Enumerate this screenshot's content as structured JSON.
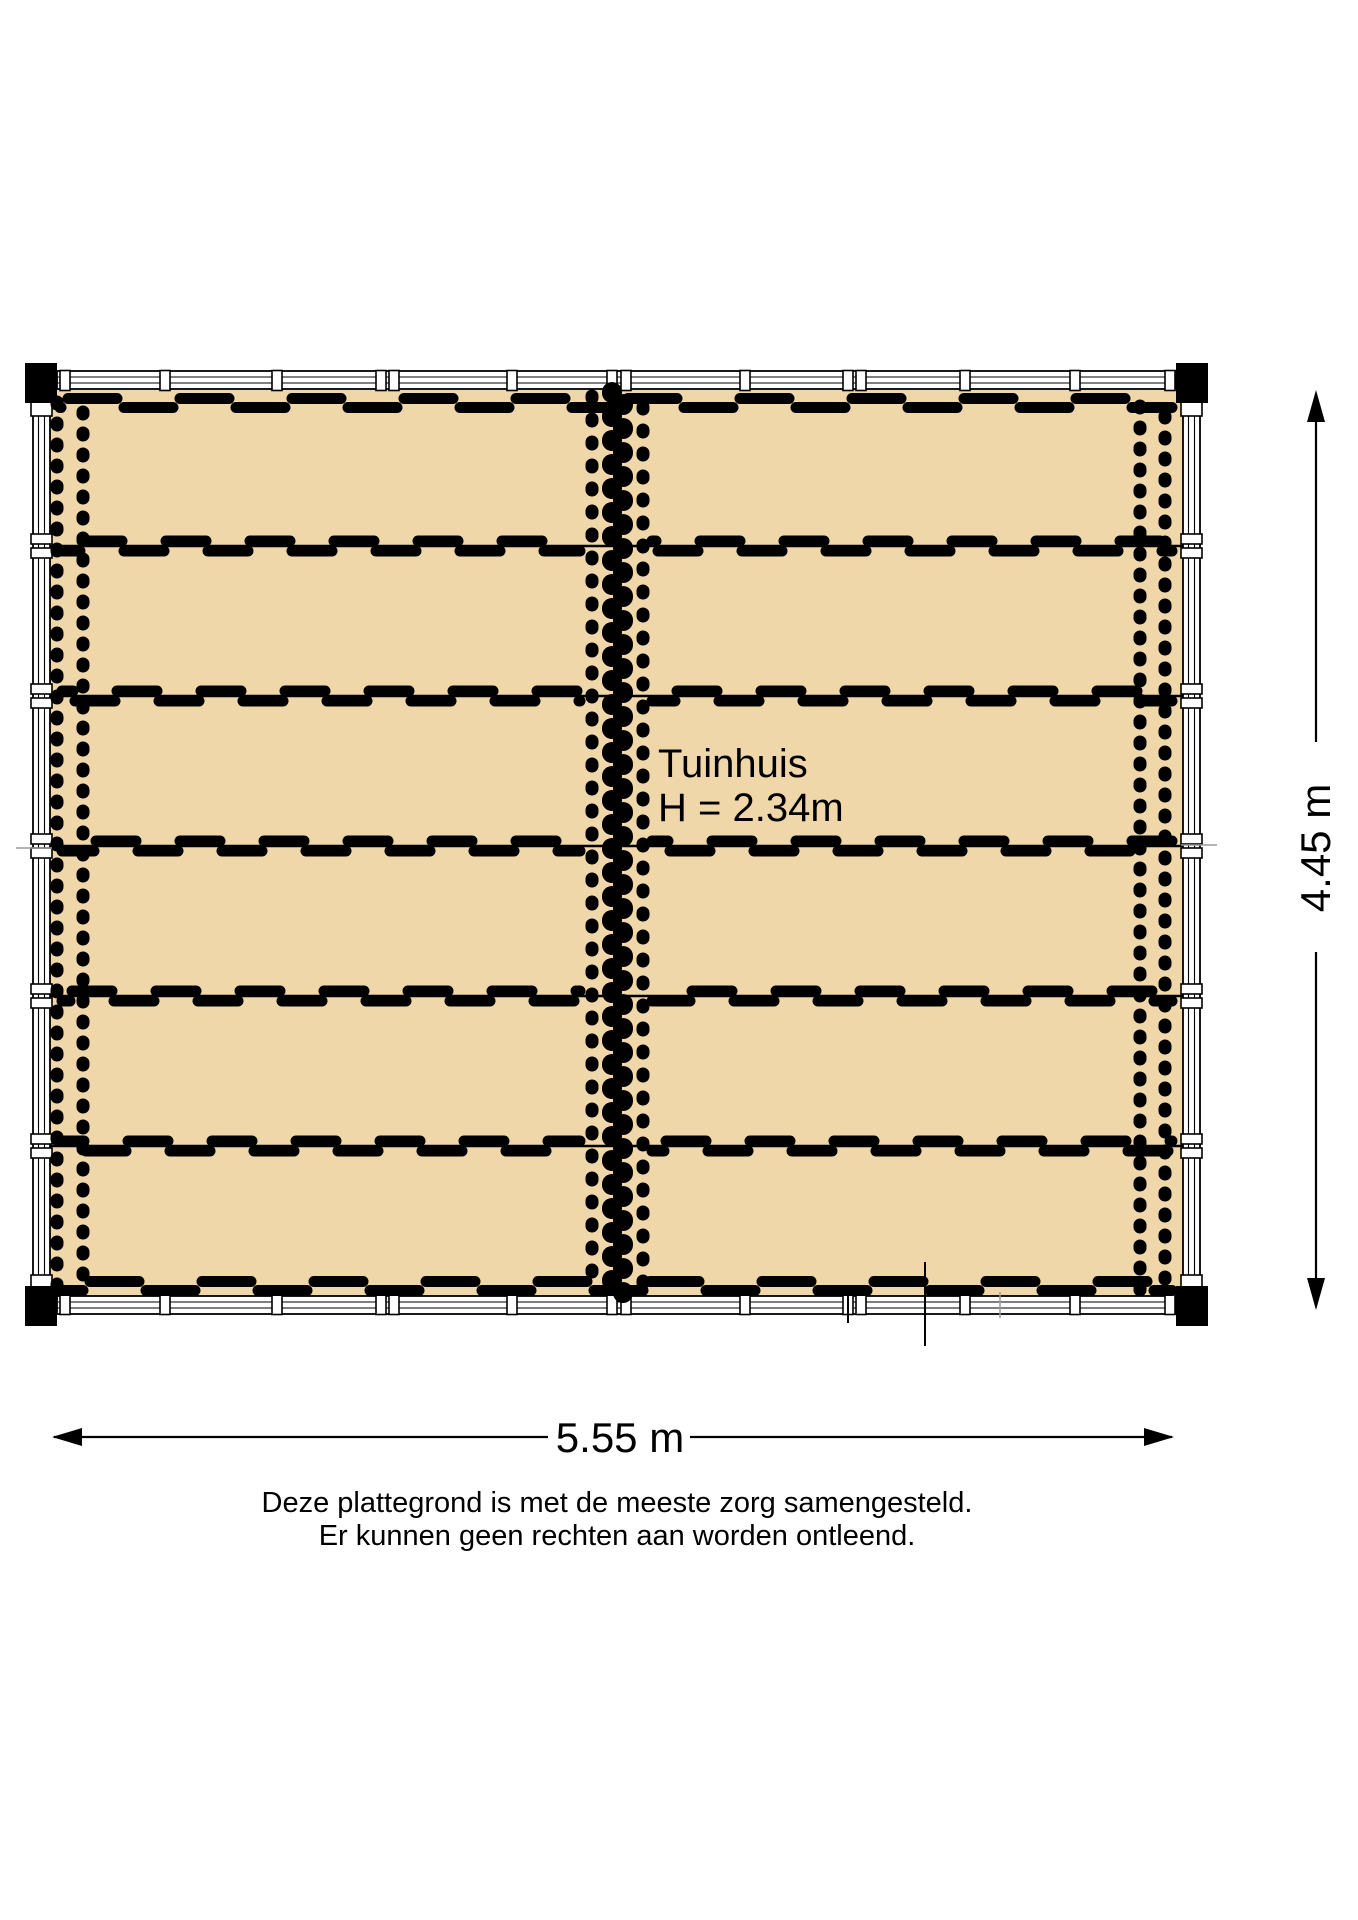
{
  "plan": {
    "room": {
      "name": "Tuinhuis",
      "height_note": "H = 2.34m"
    },
    "dimensions": {
      "width_label": "5.55 m",
      "height_label": "4.45 m"
    },
    "disclaimer": {
      "line1": "Deze plattegrond is met de meeste zorg samengesteld.",
      "line2": "Er kunnen geen rechten aan worden ontleend."
    },
    "colors": {
      "floor": "#EFD7A9",
      "ink": "#000000",
      "tick": "#9B9B9B"
    }
  }
}
